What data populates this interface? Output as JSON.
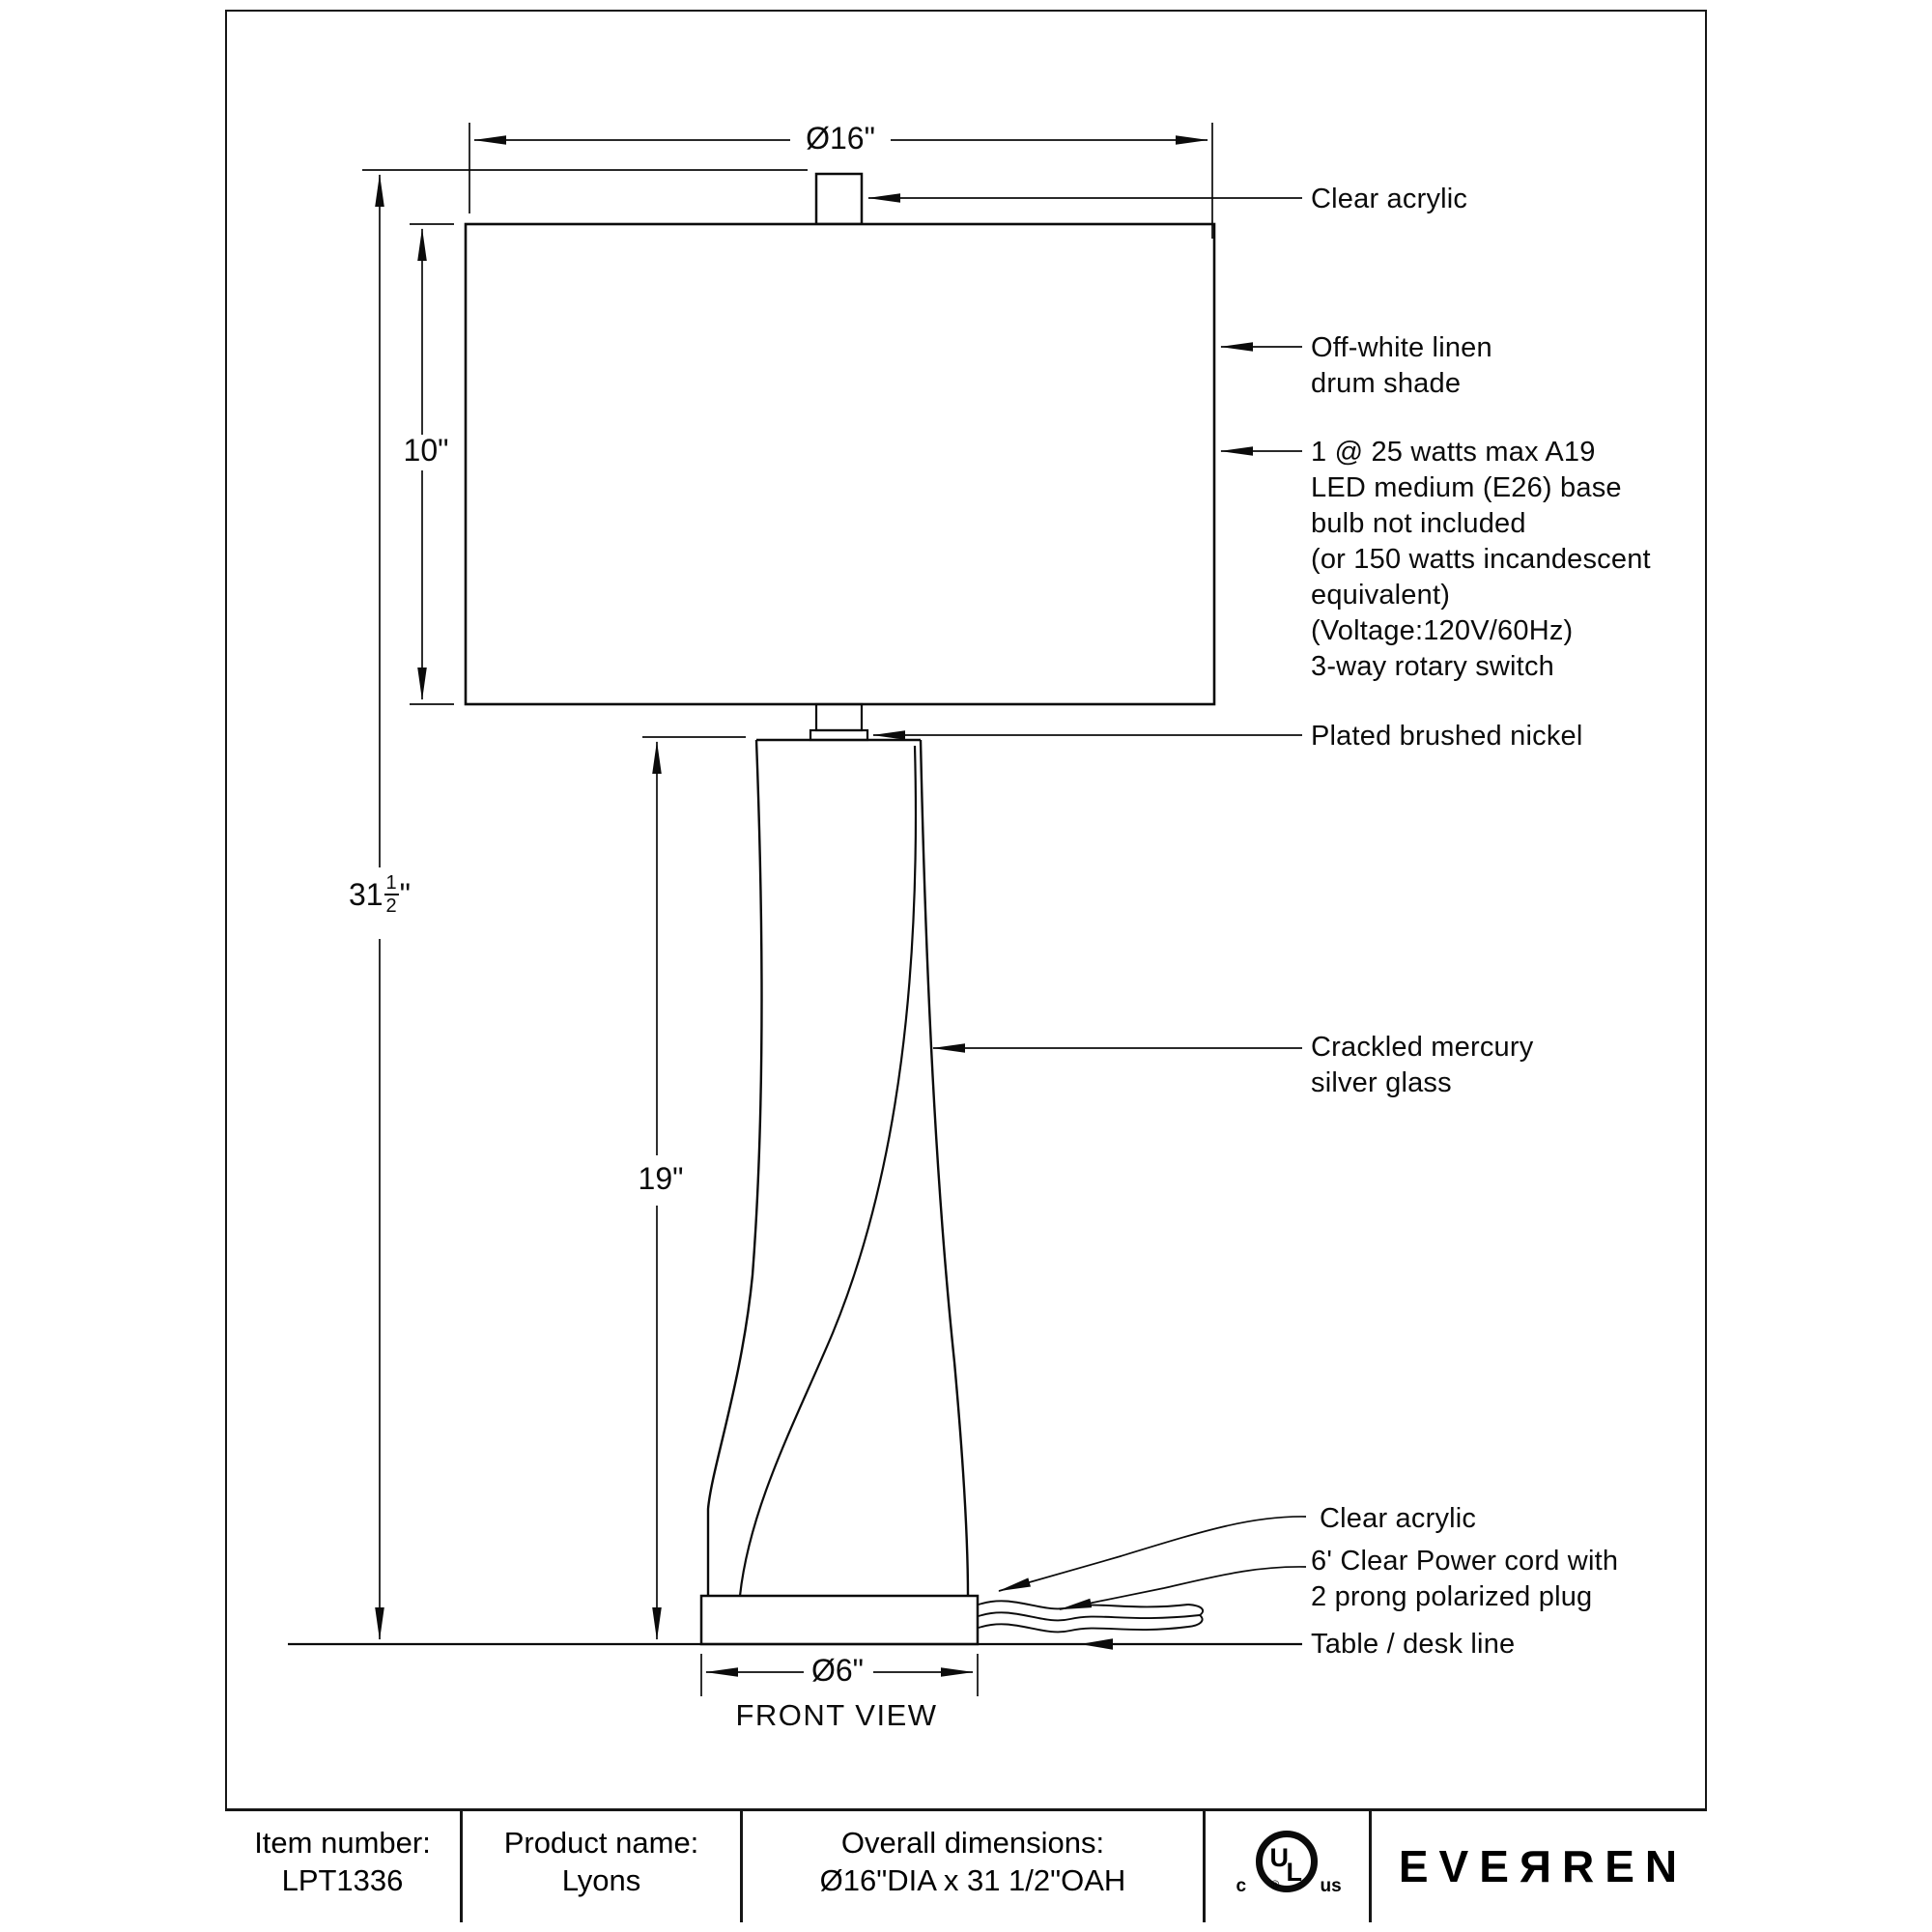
{
  "page": {
    "background": "#ffffff",
    "line_color": "#0b0b0b"
  },
  "drawing": {
    "view_label": "FRONT VIEW",
    "dimensions": {
      "shade_diameter": "Ø16\"",
      "shade_height": "10\"",
      "overall_height": {
        "whole": "31",
        "numerator": "1",
        "denominator": "2",
        "unit": "\""
      },
      "body_height": "19\"",
      "base_diameter": "Ø6\""
    },
    "callouts": {
      "finial": "Clear acrylic",
      "shade": "Off-white linen\ndrum shade",
      "bulb": "1 @ 25 watts max A19\nLED medium (E26) base\nbulb not included\n(or 150 watts incandescent\nequivalent)\n(Voltage:120V/60Hz)\n3-way rotary switch",
      "neck": "Plated brushed nickel",
      "body": "Crackled mercury\nsilver glass",
      "base": "Clear acrylic",
      "cord": "6' Clear Power cord with\n2 prong polarized plug",
      "table_line": "Table / desk line"
    }
  },
  "footer": {
    "item_label": "Item number:",
    "item_value": "LPT1336",
    "product_label": "Product name:",
    "product_value": "Lyons",
    "dims_label": "Overall dimensions:",
    "dims_value": "Ø16\"DIA x 31 1/2\"OAH",
    "brand": "EVEЯREN",
    "ul_mark": {
      "u": "U",
      "l": "L",
      "c": "c",
      "us": "us",
      "registered": "®"
    }
  }
}
